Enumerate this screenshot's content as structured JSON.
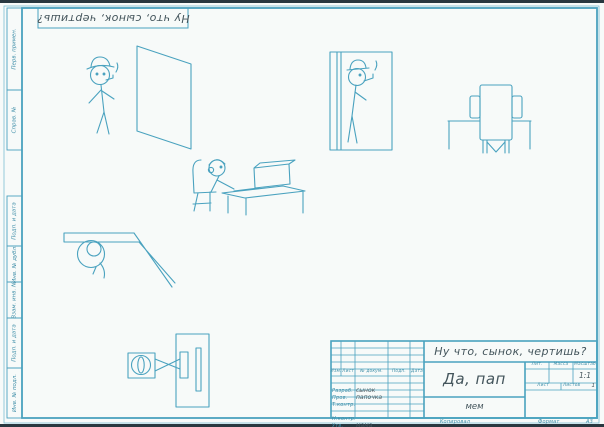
{
  "colors": {
    "drawing_line": "#4aa2bf",
    "frame_line": "#4aa2bf",
    "printed_label": "#3f8ea8",
    "handwriting_ink": "#44555c",
    "paper": "#f7faf9"
  },
  "corner_stamp": {
    "text": "Ну что, сынок, чертишь?"
  },
  "side_margin": {
    "cells": [
      {
        "label": "Перв. примен."
      },
      {
        "label": "Справ. №"
      },
      {
        "label": "Подп. и дата"
      },
      {
        "label": "Инв. № дубл."
      },
      {
        "label": "Взам. инв. №"
      },
      {
        "label": "Подп. и дата"
      },
      {
        "label": "Инв. № подл."
      }
    ]
  },
  "title_block": {
    "designation": "Ну что, сынок, чертишь?",
    "title": "Да, пап",
    "doc_note": "мем",
    "change_header": [
      "Изм.",
      "Лист",
      "№ докум.",
      "Подп.",
      "Дата"
    ],
    "signature_rows": [
      {
        "label": "Разраб.",
        "value": "сынок"
      },
      {
        "label": "Пров.",
        "value": "папочка"
      },
      {
        "label": "Т.контр.",
        "value": ""
      },
      {
        "label": "",
        "value": ""
      },
      {
        "label": "Н.контр.",
        "value": ""
      },
      {
        "label": "Утв.",
        "value": "мама"
      }
    ],
    "lit_label": "Лит.",
    "mass_label": "Масса",
    "scale_label": "Масштаб",
    "scale_value": "1:1",
    "sheet_label": "Лист",
    "sheets_label": "Листов",
    "sheets_value": "1"
  },
  "footer": {
    "copied": "Копировал",
    "format_label": "Формат",
    "format_value": "А3"
  }
}
